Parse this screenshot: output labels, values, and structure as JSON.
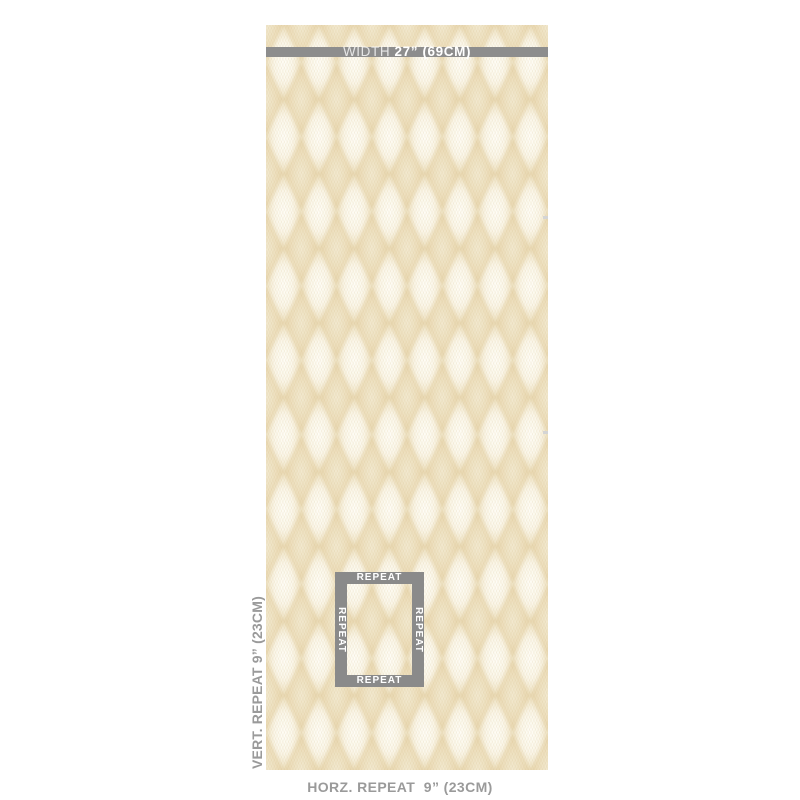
{
  "product_diagram": {
    "width_bar": {
      "label": "WIDTH ",
      "value": "27” (69CM)"
    },
    "vertical_repeat_label": "VERT. REPEAT 9” (23CM)",
    "horizontal_repeat_label": "HORZ. REPEAT  9” (23CM)",
    "repeat_box": {
      "top_label": "REPEAT",
      "bottom_label": "REPEAT",
      "left_label": "REPEAT",
      "right_label": "REPEAT"
    }
  },
  "colors": {
    "page_background": "#ffffff",
    "dimension_bar_gray": "#8d8d8d",
    "repeat_box_gray": "#8a8a8a",
    "annotation_text_gray": "#9a9a9a",
    "bar_text_white": "#ffffff",
    "pattern_tan_dark": "#e5d2a8",
    "pattern_tan_mid": "#eddfbd",
    "pattern_cream_light": "#fffef8",
    "pattern_base": "#f1e8d2"
  }
}
